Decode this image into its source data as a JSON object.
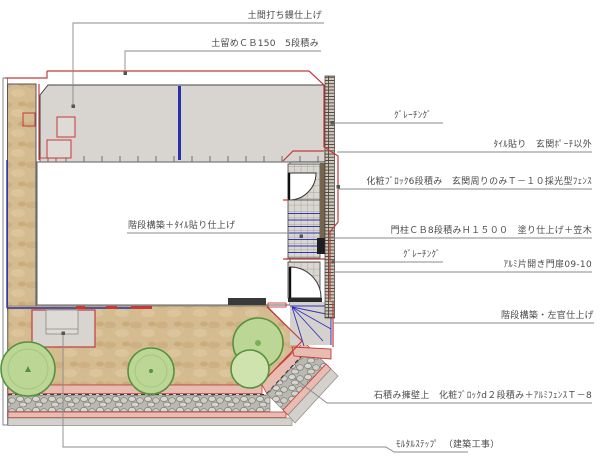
{
  "annotations": [
    {
      "id": "doma-finish",
      "text": "土間打ち鏝仕上げ"
    },
    {
      "id": "retaining-cb150",
      "text": "土留めＣＢ150　5段積み"
    },
    {
      "id": "grating-top",
      "text": "ｸﾞﾚｰﾁﾝｸﾞ"
    },
    {
      "id": "tile-finish",
      "text": "ﾀｲﾙ貼り　玄関ﾎﾟｰﾁ以外"
    },
    {
      "id": "block-fence",
      "text": "化粧ﾌﾞﾛｯｸ6段積み　玄関周りのみＴ－１０採光型ﾌｪﾝｽ"
    },
    {
      "id": "gate-pillar",
      "text": "門柱ＣＢ8段積みＨ１５００　塗り仕上げ＋笠木"
    },
    {
      "id": "grating-mid",
      "text": "ｸﾞﾚｰﾁﾝｸﾞ"
    },
    {
      "id": "gate-door",
      "text": "ｱﾙﾐ片開き門扉09-10"
    },
    {
      "id": "stair-plaster",
      "text": "階段構築・左官仕上げ"
    },
    {
      "id": "stone-wall-fence",
      "text": "石積み擁壁上　化粧ﾌﾞﾛｯｸd２段積み＋ｱﾙﾐﾌｪﾝｽＴ－8"
    },
    {
      "id": "mortar-step",
      "text": "ﾓﾙﾀﾙｽﾃｯﾌﾟ　（建築工事）"
    },
    {
      "id": "stair-tile",
      "text": "階段構築＋ﾀｲﾙ貼り仕上げ"
    }
  ],
  "colors": {
    "work_outline_red": "#c43a3c",
    "boundary_blue": "#2a2fae",
    "concrete_gray": "#d8d4cf",
    "soil_tan": "#d5bc90",
    "tree_green": "#bcd795",
    "tree_edge_green": "#55923e",
    "stone_gray": "#c9c9c4",
    "block_wall_pink": "#e8bcb1",
    "leader_gray": "#8a8a8a"
  }
}
